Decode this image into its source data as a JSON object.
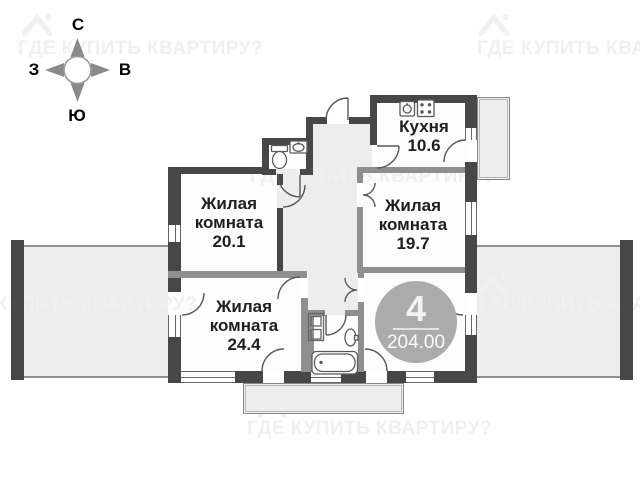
{
  "plan": {
    "title": "apartment-floor-plan",
    "compass": {
      "north": "С",
      "south": "Ю",
      "west": "З",
      "east": "В"
    },
    "watermark": {
      "text": "ГДЕ КУПИТЬ КВАРТИРУ?"
    },
    "rooms": {
      "kitchen": {
        "name": "Кухня",
        "area": "10.6"
      },
      "r201": {
        "name_line1": "Жилая",
        "name_line2": "комната",
        "area": "20.1"
      },
      "r197": {
        "name_line1": "Жилая",
        "name_line2": "комната",
        "area": "19.7"
      },
      "r244": {
        "name_line1": "Жилая",
        "name_line2": "комната",
        "area": "24.4"
      }
    },
    "badge": {
      "rooms_count": "4",
      "total_area": "204.00"
    },
    "colors": {
      "wall": "#474747",
      "partition": "#8f8f8f",
      "hall_fill": "#ededed",
      "room_fill": "#fdfdfd",
      "badge_bg": "#ababab",
      "watermark": "#f0f0f0",
      "label_text": "#1e1e1e"
    }
  }
}
